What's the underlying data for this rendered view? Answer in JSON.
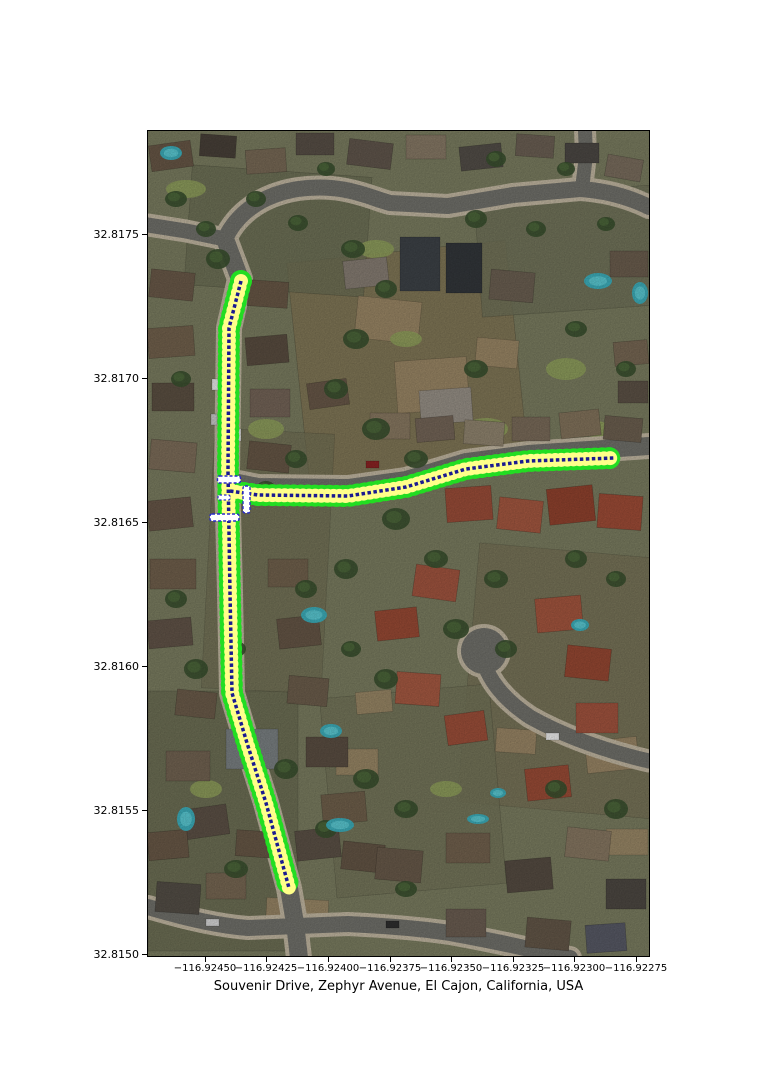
{
  "figure": {
    "title": "Souvenir Drive, Zephyr Avenue, El Cajon, California, USA"
  },
  "axes": {
    "x_ticks": [
      "−116.92450",
      "−116.92425",
      "−116.92400",
      "−116.92375",
      "−116.92350",
      "−116.92325",
      "−116.92300",
      "−116.92275"
    ],
    "y_ticks": [
      "32.8175",
      "32.8170",
      "32.8165",
      "32.8160",
      "32.8155",
      "32.8150"
    ]
  },
  "map": {
    "route_colors": {
      "edge": "#22dd22",
      "lane": "#ffff8a",
      "centerline": "#1a1a90",
      "crossing_fill": "#ffffff",
      "crossing_stroke": "#2a2ac8"
    }
  }
}
